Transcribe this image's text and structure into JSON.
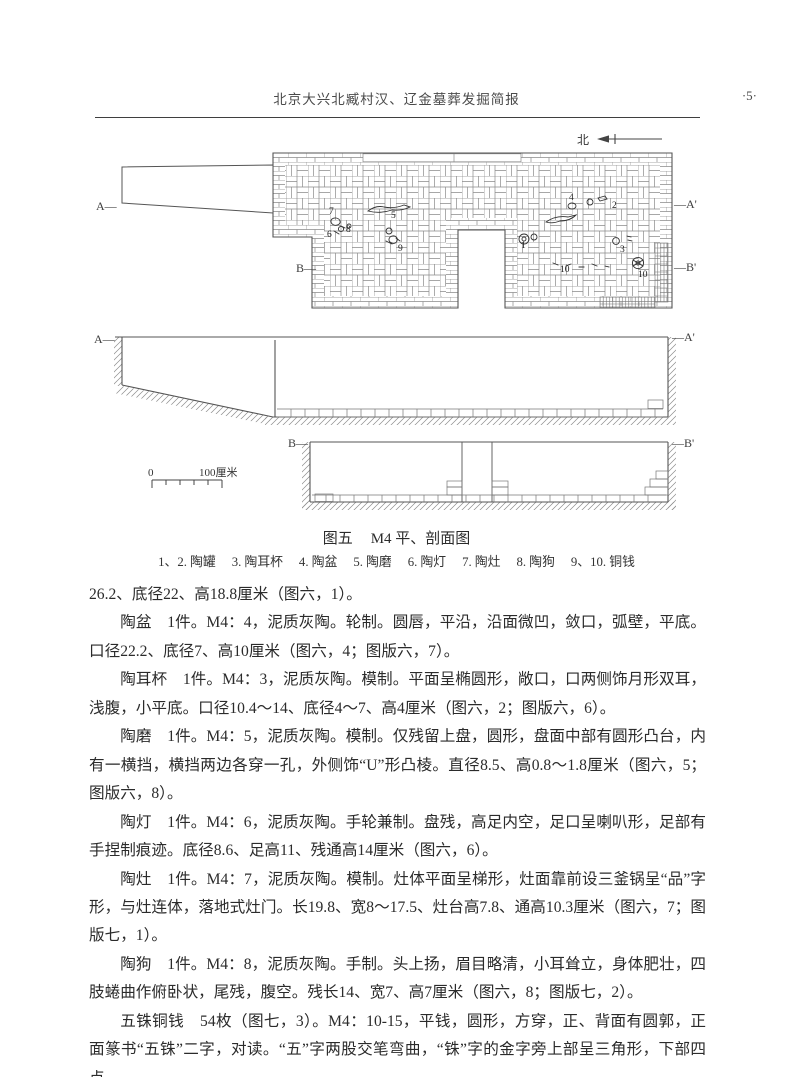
{
  "header": {
    "title": "北京大兴北臧村汉、辽金墓葬发掘简报",
    "page_number": "·5·"
  },
  "figure": {
    "north_label": "北",
    "caption": {
      "label": "图五",
      "title": "M4 平、剖面图"
    },
    "legend_items": [
      "1、2. 陶罐",
      "3. 陶耳杯",
      "4. 陶盆",
      "5. 陶磨",
      "6. 陶灯",
      "7. 陶灶",
      "8. 陶狗",
      "9、10. 铜钱"
    ],
    "scale": {
      "start": "0",
      "end": "100厘米"
    },
    "plan": {
      "left_label": "A—",
      "right_label": "—A'",
      "b_left_label": "B—",
      "b_right_label": "—B'",
      "markers": [
        {
          "n": "7",
          "x": 329,
          "y": 214
        },
        {
          "n": "6",
          "x": 327,
          "y": 237
        },
        {
          "n": "8",
          "x": 346,
          "y": 232
        },
        {
          "n": "5",
          "x": 391,
          "y": 218
        },
        {
          "n": "9",
          "x": 398,
          "y": 251
        },
        {
          "n": "4",
          "x": 569,
          "y": 200
        },
        {
          "n": "2",
          "x": 612,
          "y": 208
        },
        {
          "n": "1",
          "x": 521,
          "y": 248
        },
        {
          "n": "3",
          "x": 620,
          "y": 252
        },
        {
          "n": "10",
          "x": 560,
          "y": 272
        },
        {
          "n": "10",
          "x": 638,
          "y": 277
        }
      ]
    },
    "section_aa": {
      "left": "A—",
      "right": "—A'"
    },
    "section_bb": {
      "left": "B—",
      "right": "—B'"
    }
  },
  "article": {
    "paragraphs": [
      {
        "indent": false,
        "text": "26.2、底径22、高18.8厘米（图六，1）。"
      },
      {
        "indent": true,
        "text": "陶盆　1件。M4：4，泥质灰陶。轮制。圆唇，平沿，沿面微凹，敛口，弧壁，平底。口径22.2、底径7、高10厘米（图六，4；图版六，7）。"
      },
      {
        "indent": true,
        "text": "陶耳杯　1件。M4：3，泥质灰陶。模制。平面呈椭圆形，敞口，口两侧饰月形双耳，浅腹，小平底。口径10.4～14、底径4～7、高4厘米（图六，2；图版六，6）。"
      },
      {
        "indent": true,
        "text": "陶磨　1件。M4：5，泥质灰陶。模制。仅残留上盘，圆形，盘面中部有圆形凸台，内有一横挡，横挡两边各穿一孔，外侧饰“U”形凸棱。直径8.5、高0.8～1.8厘米（图六，5；图版六，8）。"
      },
      {
        "indent": true,
        "text": "陶灯　1件。M4：6，泥质灰陶。手轮兼制。盘残，高足内空，足口呈喇叭形，足部有手捏制痕迹。底径8.6、足高11、残通高14厘米（图六，6）。"
      },
      {
        "indent": true,
        "text": "陶灶　1件。M4：7，泥质灰陶。模制。灶体平面呈梯形，灶面靠前设三釜锅呈“品”字形，与灶连体，落地式灶门。长19.8、宽8～17.5、灶台高7.8、通高10.3厘米（图六，7；图版七，1）。"
      },
      {
        "indent": true,
        "text": "陶狗　1件。M4：8，泥质灰陶。手制。头上扬，眉目略清，小耳耸立，身体肥壮，四肢蜷曲作俯卧状，尾残，腹空。残长14、宽7、高7厘米（图六，8；图版七，2）。"
      },
      {
        "indent": true,
        "text": "五铢铜钱　54枚（图七，3）。M4：10-15，平钱，圆形，方穿，正、背面有圆郭，正面篆书“五铢”二字，对读。“五”字两股交笔弯曲，“铢”字的金字旁上部呈三角形，下部四点"
      }
    ]
  }
}
